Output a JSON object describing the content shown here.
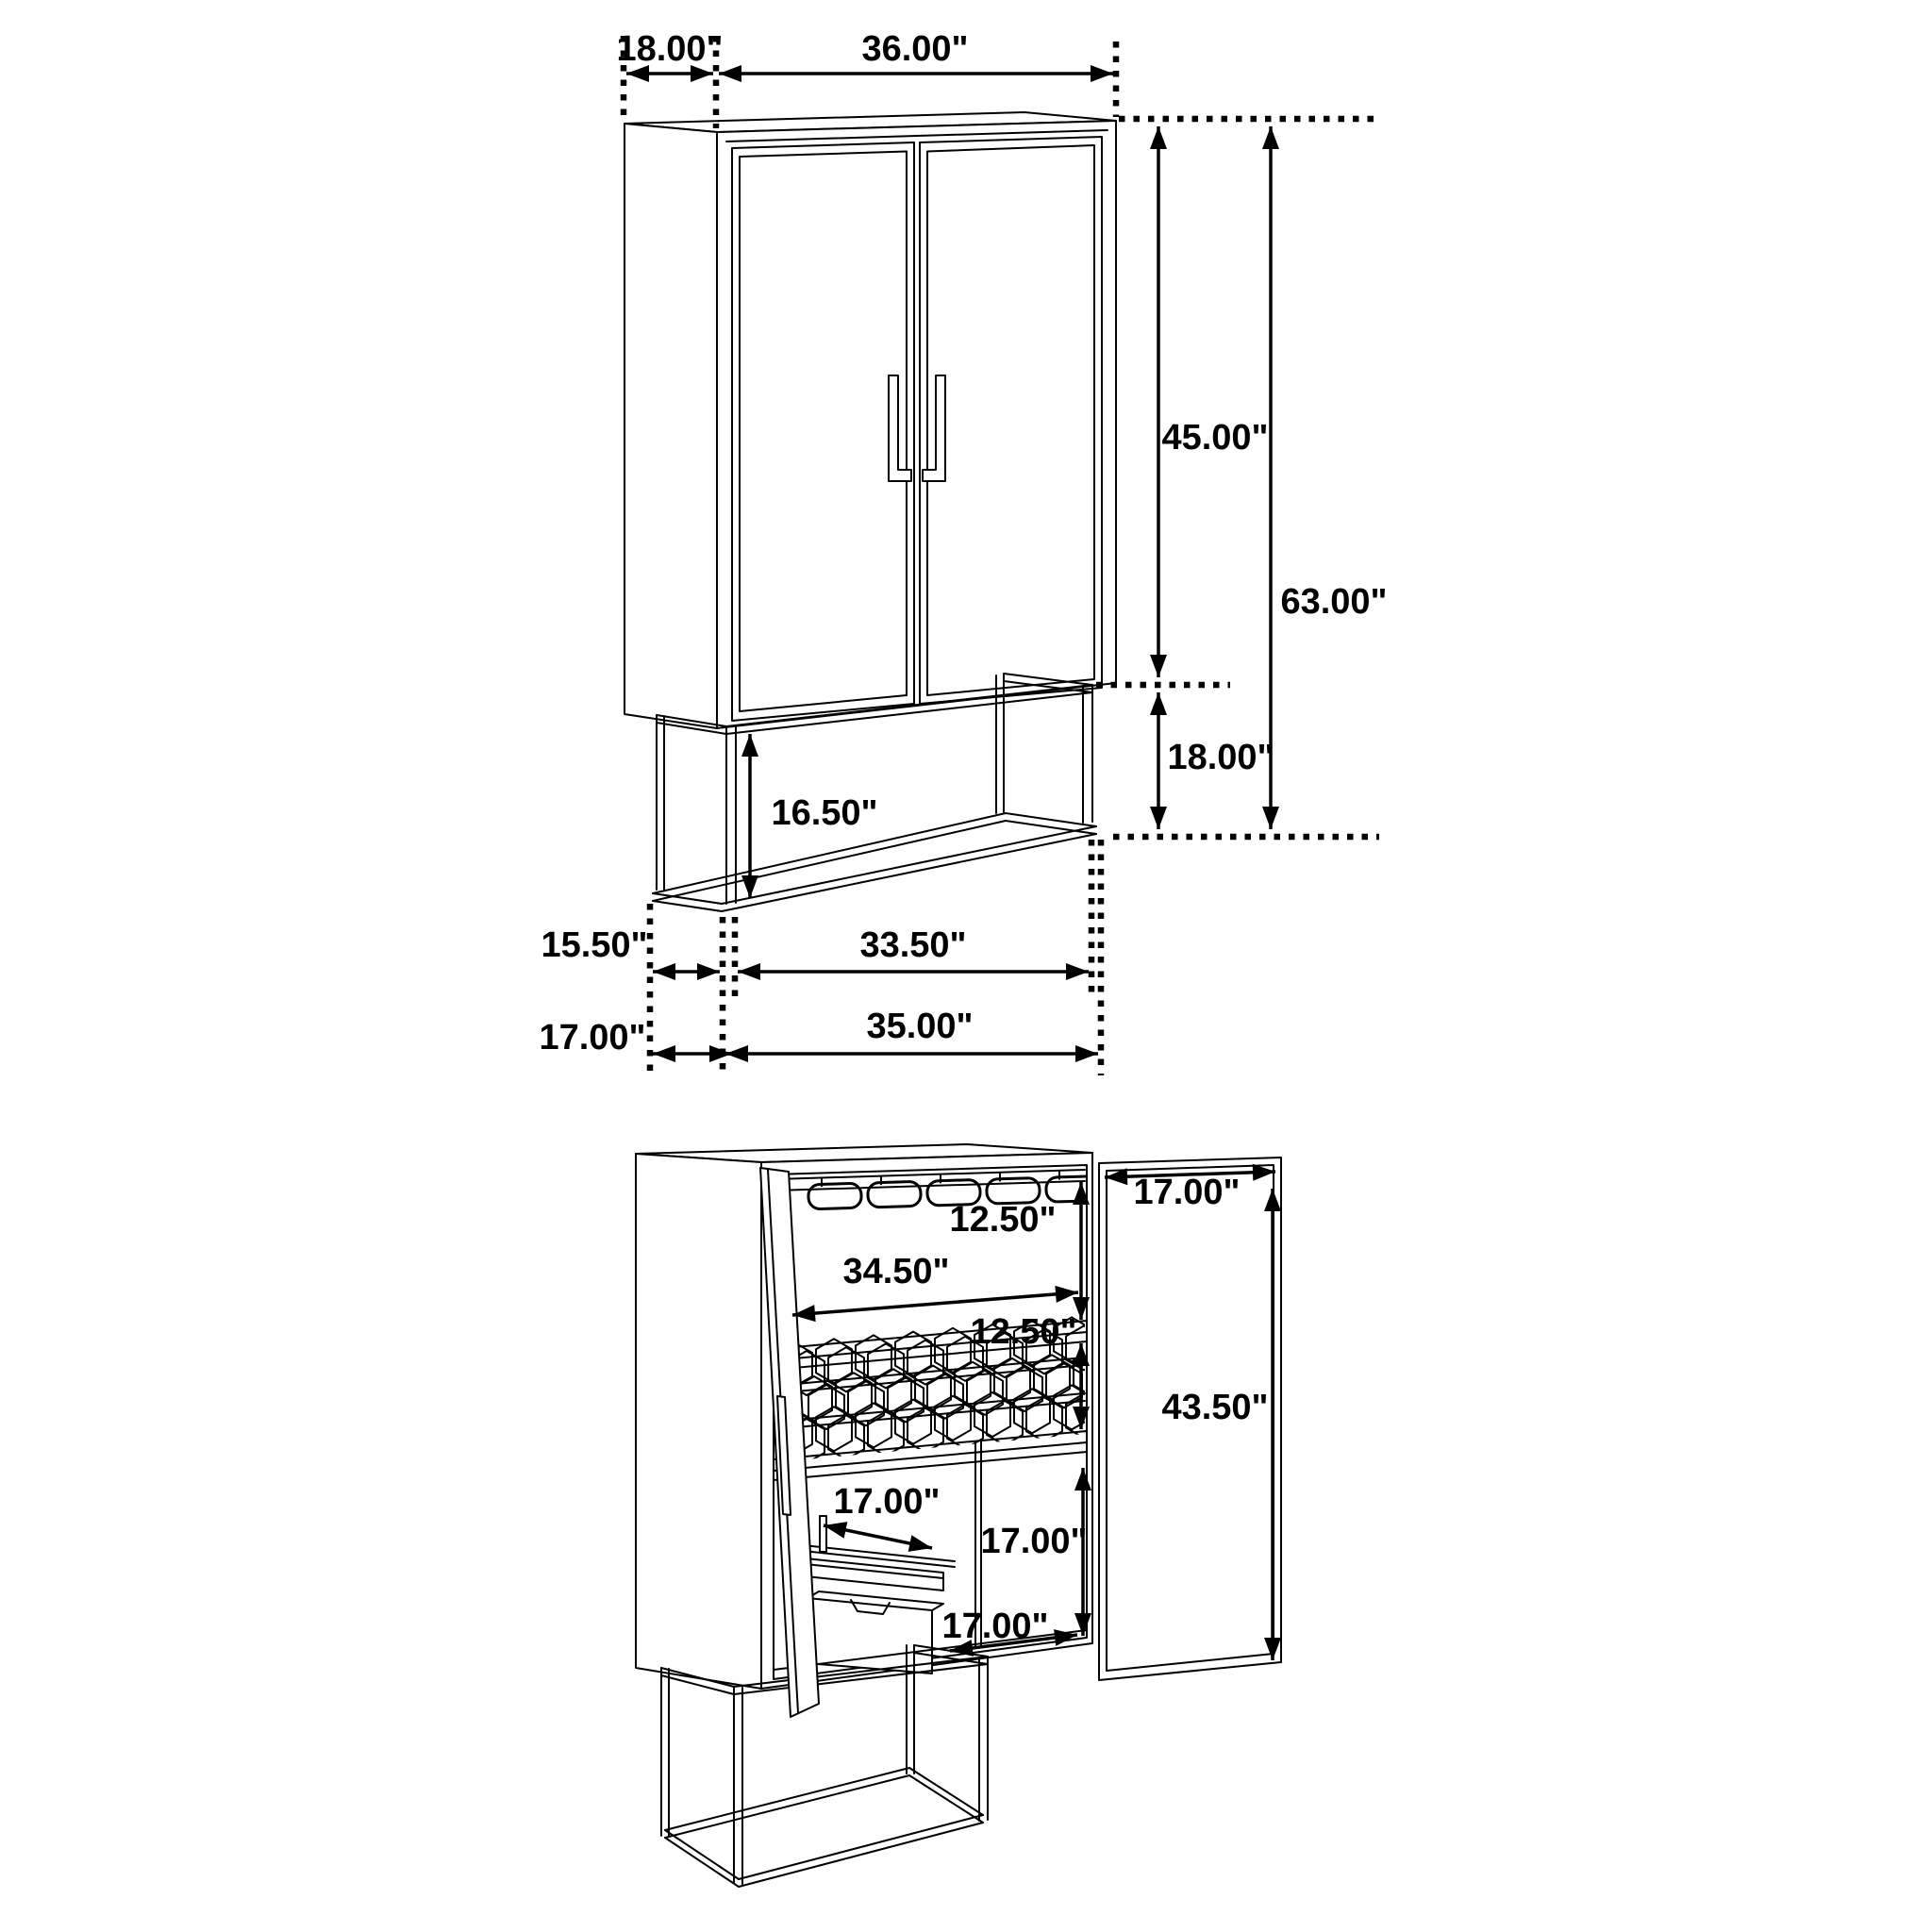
{
  "drawing": {
    "background": "#ffffff",
    "line_color": "#000000",
    "closed_view": {
      "top_depth": "18.00\"",
      "top_width": "36.00\"",
      "upper_cabinet_height": "45.00\"",
      "overall_height": "63.00\"",
      "base_height": "18.00\"",
      "base_opening_height": "16.50\"",
      "base_inner_depth": "15.50\"",
      "base_inner_width": "33.50\"",
      "base_depth": "17.00\"",
      "base_width": "35.00\""
    },
    "open_view": {
      "stemware_section_height": "12.50\"",
      "shelf_width": "34.50\"",
      "wine_rack_section_height": "12.50\"",
      "door_width": "17.00\"",
      "door_height": "43.50\"",
      "tray_width": "17.00\"",
      "lower_section_height": "17.00\"",
      "bottom_shelf_depth": "17.00\""
    }
  }
}
